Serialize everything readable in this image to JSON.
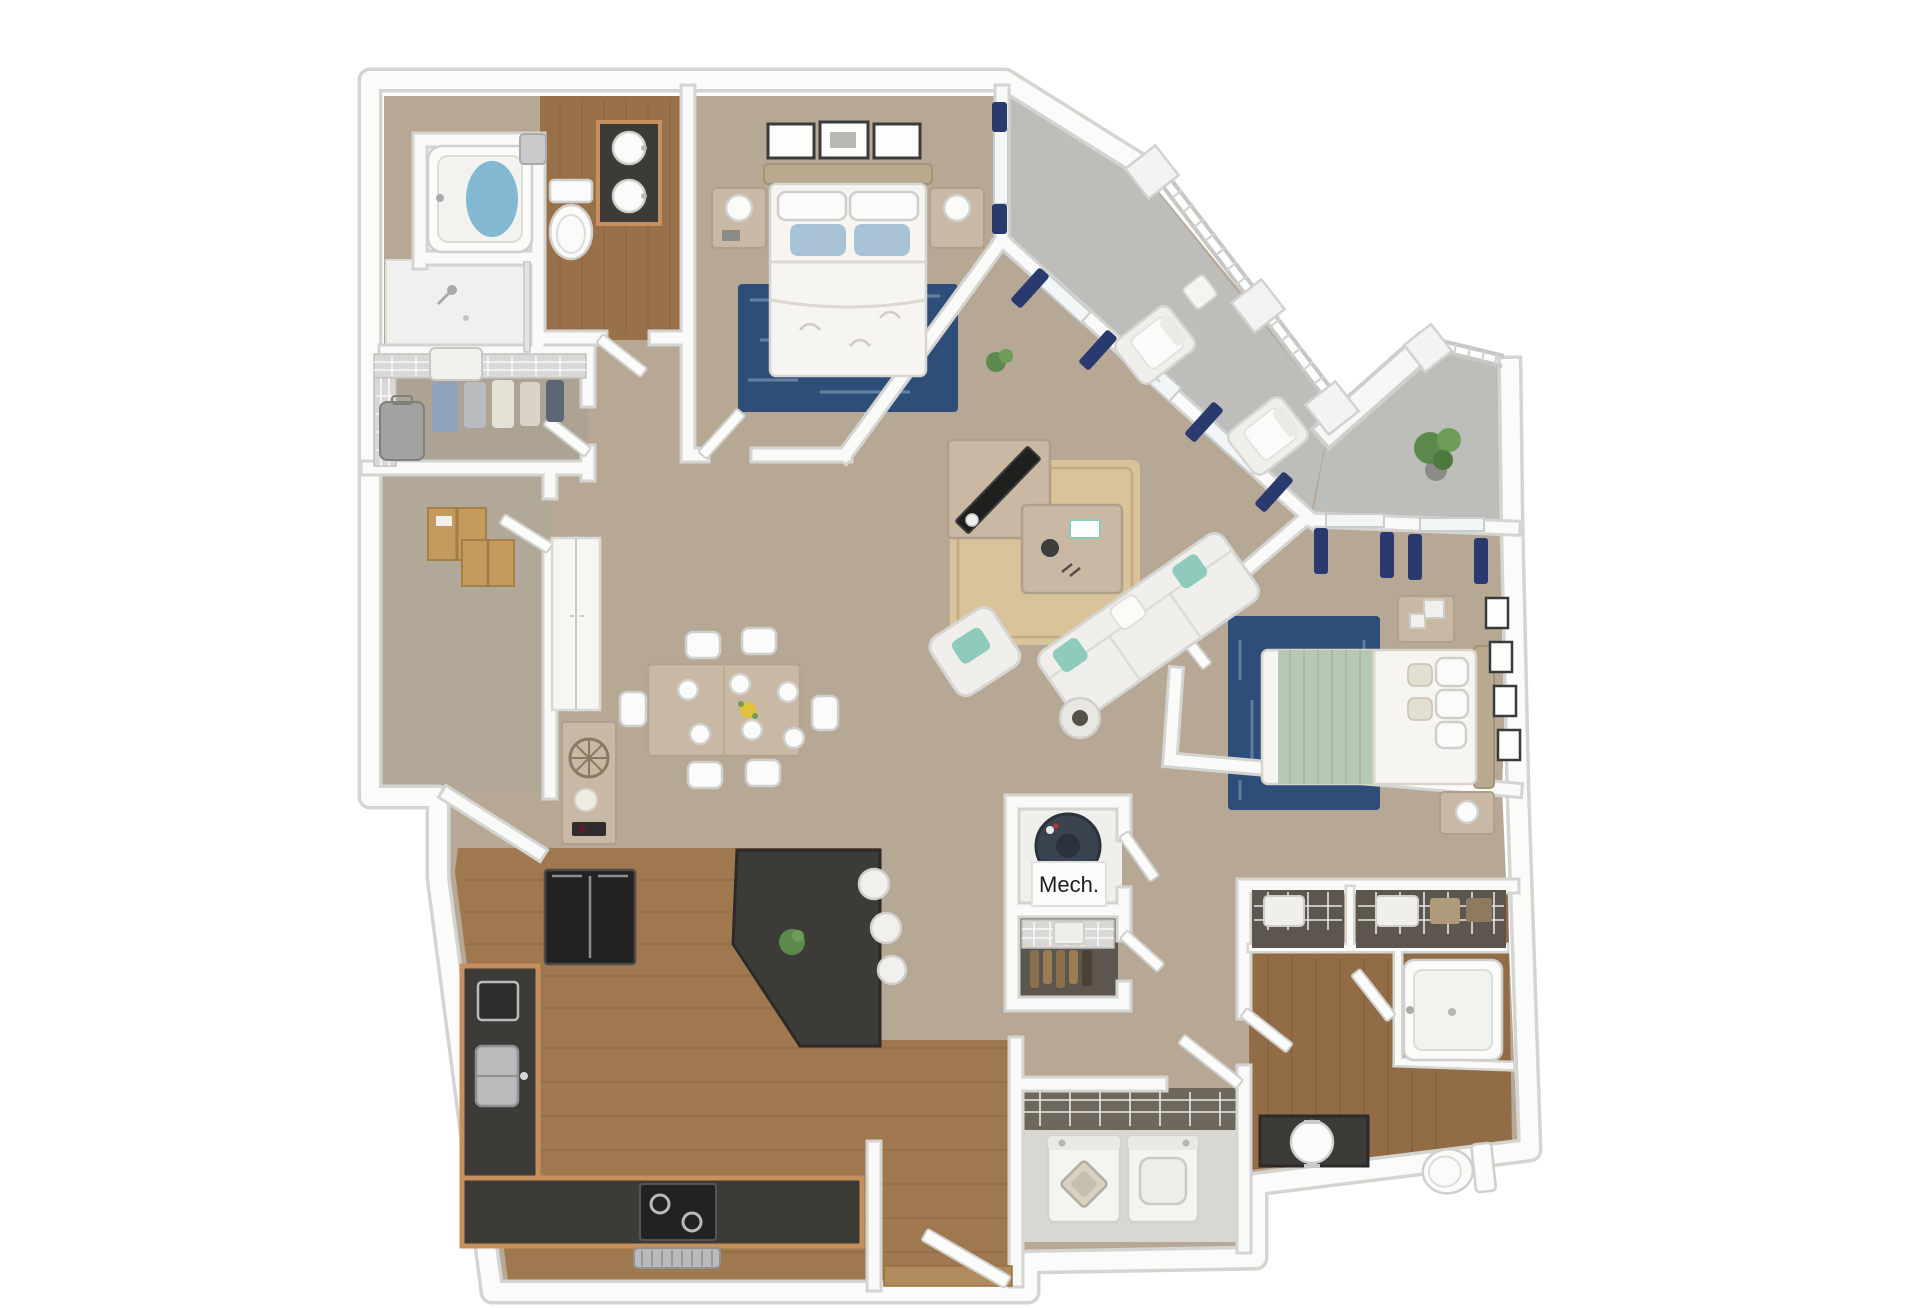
{
  "labels": {
    "mech_room": "Mech."
  },
  "palette": {
    "background": "#ffffff",
    "wall_edge": "#d4d4d1",
    "wall_core": "#fafaf8",
    "carpet": "#b7a896",
    "carpet_closet": "#aca395",
    "carpet_storage": "#b1a898",
    "wood_floor": "#98714b",
    "kitchen_wood": "#a0784f",
    "bath2_wood": "#916c47",
    "concrete": "#bdbdba",
    "navy_rug": "#2e4d78",
    "jute_rug": "#d8c39a",
    "curtain_navy": "#2b3a6e",
    "granite": "#3c3b38",
    "cabinet_wood": "#c78f5e",
    "light_wood": "#c9b9a4",
    "sofa_white": "#f0efeb",
    "teal_pillow": "#8ecbbd",
    "blue_pillow": "#a9c3d6",
    "sage": "#b8c8b3",
    "water_blue": "#82b8d2",
    "appliance_black": "#232221",
    "steel": "#b9babb",
    "cardboard": "#c49a5f",
    "plant_green": "#5d8a4c",
    "water_heater": "#3a4450",
    "closet_dark": "#5c564e",
    "laundry_dark": "#6e675c"
  },
  "rooms": [
    {
      "id": "bathroom-1",
      "floor": "wood",
      "fixtures": [
        "garden-tub",
        "walk-in-shower",
        "toilet",
        "double-sink-vanity",
        "towel-ring"
      ]
    },
    {
      "id": "walk-in-closet",
      "floor": "carpet",
      "fixtures": [
        "wire-shelving",
        "hanging-clothes",
        "suitcase",
        "basket"
      ]
    },
    {
      "id": "storage-room",
      "floor": "carpet",
      "fixtures": [
        "cardboard-boxes"
      ]
    },
    {
      "id": "bedroom-1",
      "floor": "carpet",
      "fixtures": [
        "queen-bed",
        "two-nightstands",
        "lamps",
        "three-wall-frames",
        "navy-area-rug",
        "window-curtains"
      ]
    },
    {
      "id": "balcony",
      "floor": "concrete",
      "fixtures": [
        "railing",
        "two-lounge-chairs",
        "side-table",
        "potted-plant",
        "privacy-wall"
      ]
    },
    {
      "id": "living-room",
      "floor": "carpet",
      "fixtures": [
        "sofa",
        "armchair",
        "coffee-table",
        "tv-console",
        "tv",
        "jute-rug",
        "floor-lamp",
        "plant"
      ]
    },
    {
      "id": "dining-area",
      "floor": "carpet",
      "fixtures": [
        "dining-table",
        "six-chairs",
        "place-settings",
        "flower-centerpiece",
        "console-cabinet",
        "pantry-cabinet"
      ]
    },
    {
      "id": "kitchen",
      "floor": "wood",
      "fixtures": [
        "l-shaped-granite-counter",
        "refrigerator",
        "sink",
        "range",
        "vent-hood",
        "angled-island",
        "bar-stools",
        "island-plant"
      ]
    },
    {
      "id": "entry",
      "floor": "wood",
      "fixtures": [
        "front-door"
      ]
    },
    {
      "id": "mech-room",
      "floor": "hard",
      "fixtures": [
        "water-heater"
      ],
      "label": "Mech."
    },
    {
      "id": "coat-closet",
      "floor": "hard",
      "fixtures": [
        "wire-shelf",
        "hanging-coats"
      ]
    },
    {
      "id": "laundry-room",
      "floor": "hard",
      "fixtures": [
        "washer",
        "dryer",
        "laundry-basket",
        "wire-shelf"
      ]
    },
    {
      "id": "bathroom-2",
      "floor": "wood",
      "fixtures": [
        "bathtub",
        "toilet",
        "sink-vanity",
        "two-linen-closets"
      ]
    },
    {
      "id": "bedroom-2",
      "floor": "carpet",
      "fixtures": [
        "queen-bed",
        "two-nightstands",
        "navy-area-rug",
        "four-wall-frames",
        "window-curtains"
      ]
    }
  ]
}
